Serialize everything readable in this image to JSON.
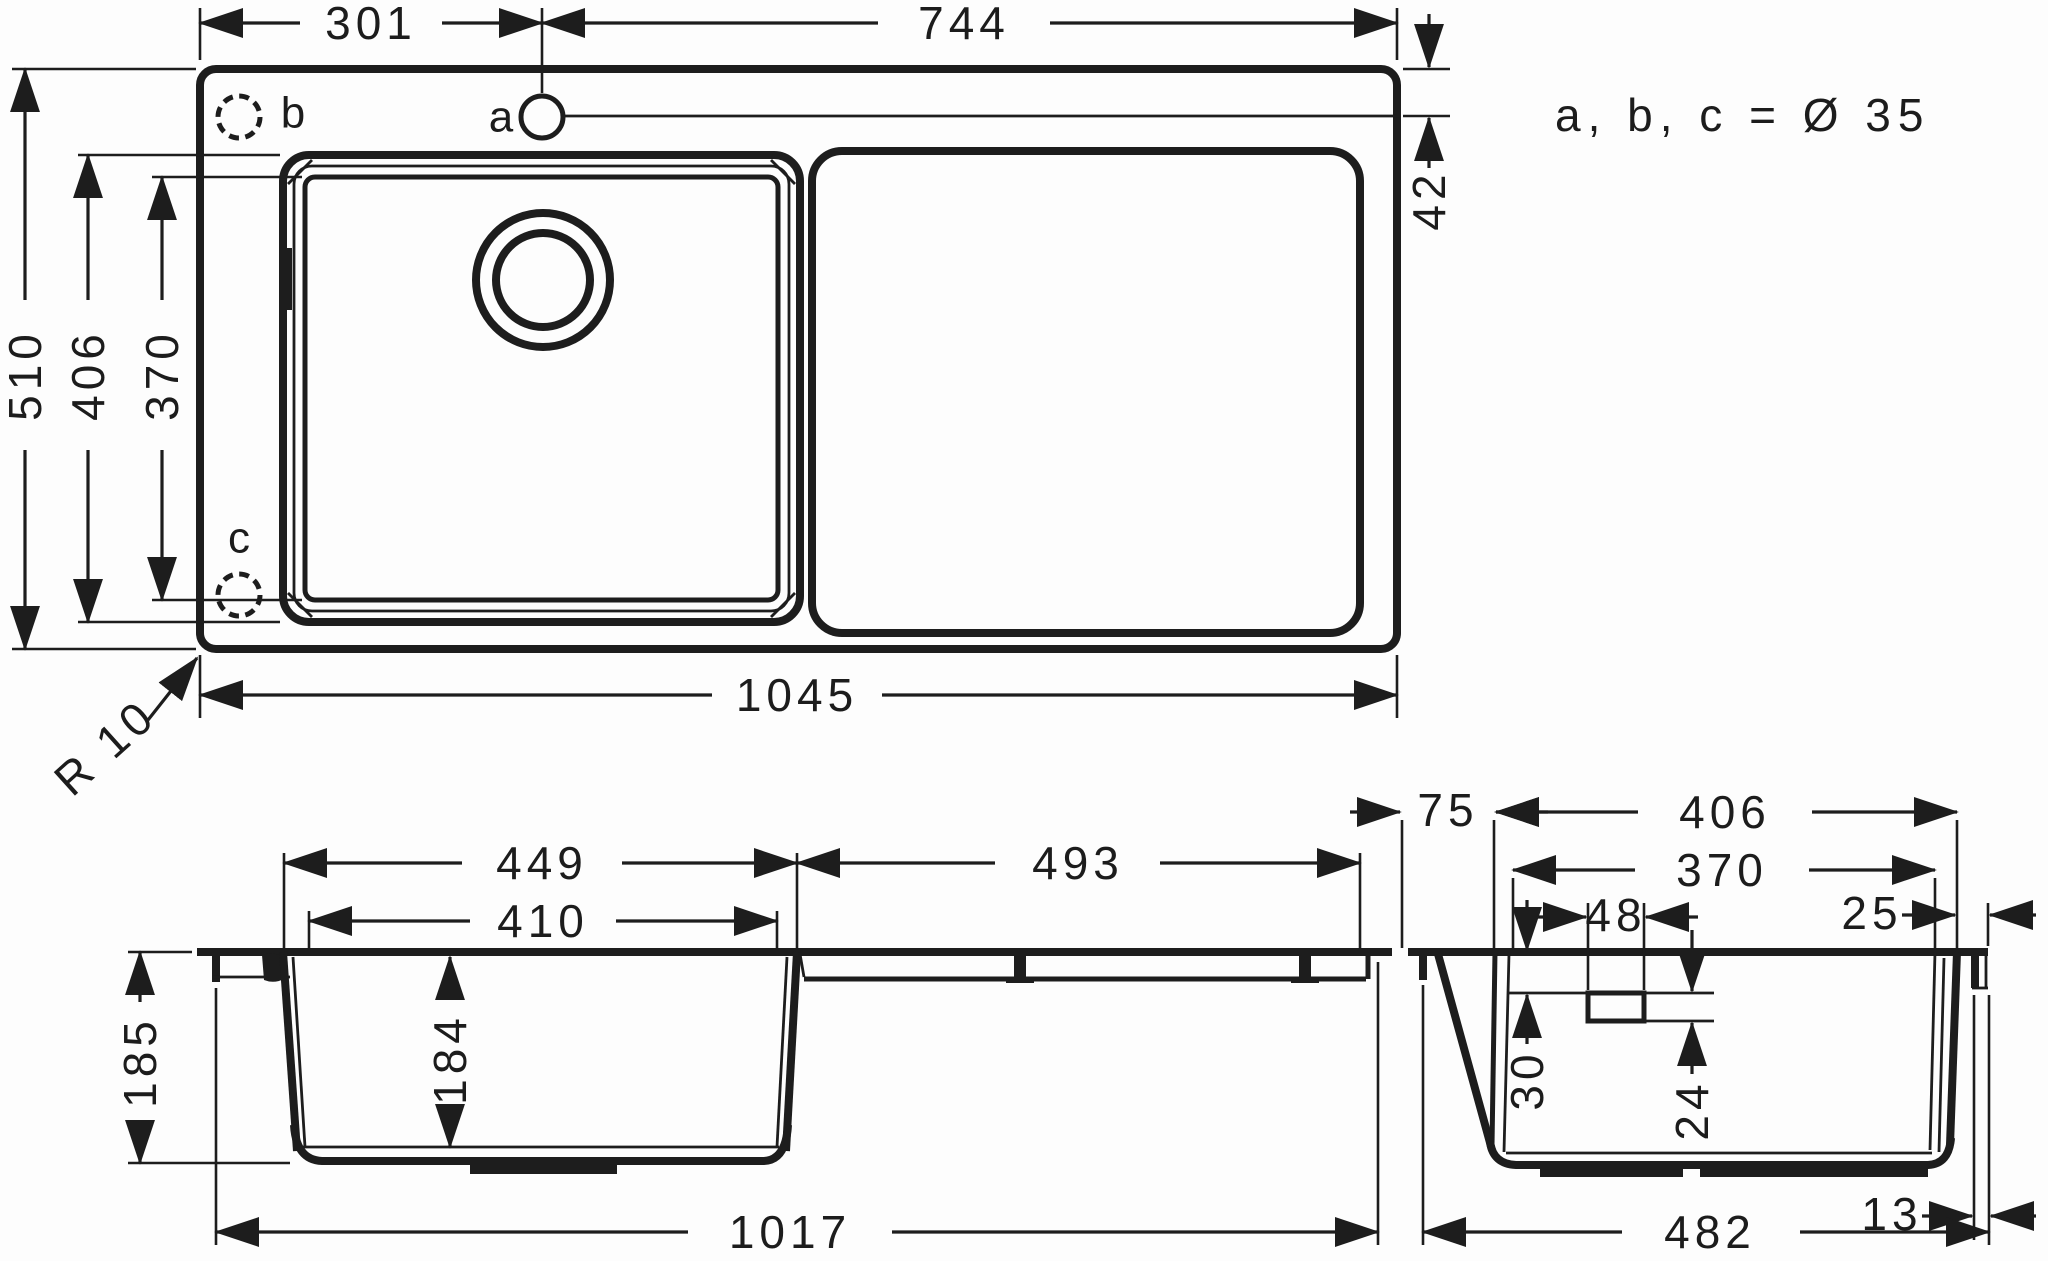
{
  "drawing_title": "Kitchen sink dimensional drawing",
  "note": "a, b, c = Ø 35",
  "top_view": {
    "dims": {
      "width_left": "301",
      "width_right": "744",
      "hole_offset": "42",
      "overall_depth": "510",
      "bowl_outer_depth": "406",
      "bowl_inner_depth": "370",
      "overall_width": "1045",
      "corner_radius": "R 10"
    },
    "holes": {
      "a": "a",
      "b": "b",
      "c": "c"
    }
  },
  "front_view": {
    "dims": {
      "bowl_outer_width": "449",
      "drainboard_width": "493",
      "bowl_inner_width": "410",
      "overall_height": "185",
      "bowl_depth": "184",
      "bottom_width": "1017"
    }
  },
  "side_view": {
    "dims": {
      "rear_overhang": "75",
      "bowl_outer_depth": "406",
      "bowl_inner_depth": "370",
      "overflow_width": "48",
      "front_edge": "25",
      "overflow_top_offset": "30",
      "overflow_height": "24",
      "lip_width": "13",
      "bottom_depth": "482"
    }
  }
}
